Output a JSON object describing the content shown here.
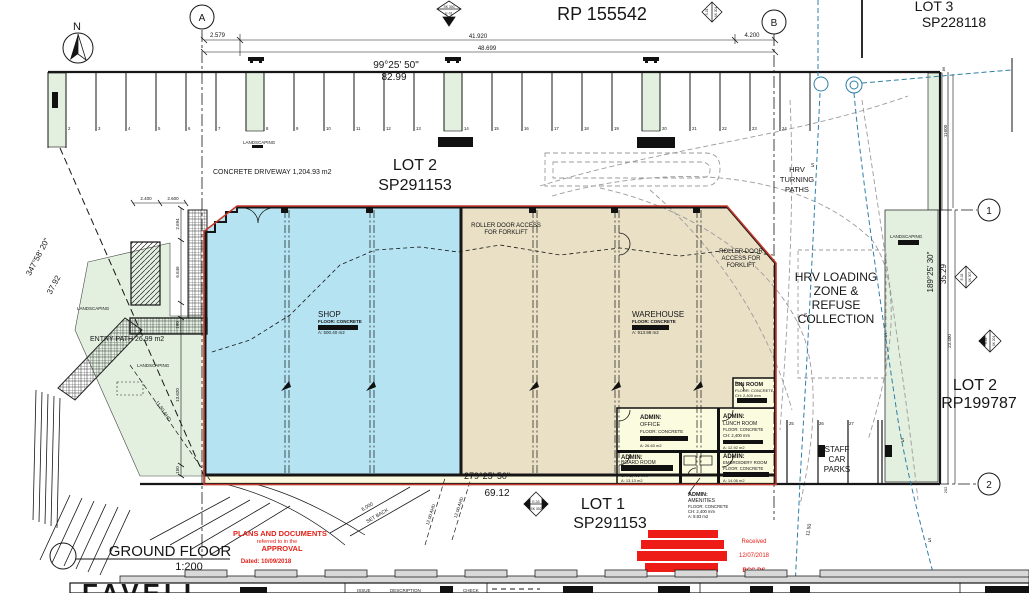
{
  "north_label": "N",
  "grid": {
    "a": "A",
    "b": "B",
    "r1": "1",
    "r2": "2"
  },
  "lots": {
    "rp_top": "RP 155542",
    "lot3_1": "LOT 3",
    "lot3_2": "SP228118",
    "lot2_1": "LOT 2",
    "lot2_2": "SP291153",
    "lot2r_1": "LOT 2",
    "lot2r_2": "RP199787",
    "lot1_1": "LOT 1",
    "lot1_2": "SP291153"
  },
  "dimensions": {
    "d1": "2.579",
    "d2": "41.920",
    "d3": "4.200",
    "d4": "48.699",
    "top_bearing": "99°25' 50\"",
    "top_dist": "82.99",
    "bottom_bearing": "279°25' 50\"",
    "bottom_dist": "69.12",
    "left_bearing": "347°58' 20\"",
    "left_dist": "37.92",
    "right_bearing": "189°25' 30\"",
    "right_dist": "35.29",
    "h1": "2.400",
    "h2": "2.600",
    "v1": "2.694",
    "v2": "6.646",
    "v3": "190",
    "v4": "13.620",
    "v5": "150",
    "r1": "11600",
    "r2": "86",
    "r3": "23.400",
    "r4": "202",
    "setback1": "6.000",
    "setback2": "SET BACK",
    "contour_left": "11.50 AHD",
    "contour_right": "11.50",
    "contour_a": "12.00 AHD",
    "contour_b": "12.00 AHD"
  },
  "site_labels": {
    "driveway": "CONCRETE DRIVEWAY 1,204.93 m2",
    "entry": "ENTRY PATH 26.99 m2",
    "landscaping": "LANDSCAPING",
    "hrv1": "HRV",
    "hrv2": "TURNING",
    "hrv3": "PATHS",
    "load1": "HRV LOADING",
    "load2": "ZONE &",
    "load3": "REFUSE",
    "load4": "COLLECTION",
    "staff1": "STAFF",
    "staff2": "CAR",
    "staff3": "PARKS",
    "roller_a1": "ROLLER DOOR ACCESS",
    "roller_a2": "FOR FORKLIFT",
    "roller_b1": "ROLLER DOOR",
    "roller_b2": "ACCESS FOR",
    "roller_b3": "FORKLIFT",
    "s": "S"
  },
  "rooms": {
    "shop_name": "SHOP",
    "shop_floor": "FLOOR: CONCRETE",
    "shop_area": "A: 500.40 m2",
    "wh_name": "WAREHOUSE",
    "wh_floor": "FLOOR: CONCRETE",
    "wh_area": "A: 913.98 m2",
    "bin_name": "BIN ROOM",
    "bin_floor": "FLOOR: CONCRETE",
    "bin_ch": "CH: 2,400 mm",
    "office_t": "ADMIN:",
    "office_n": "OFFICE",
    "office_floor": "FLOOR: CONCRETE",
    "office_area": "A: 26.63 m2",
    "lunch_t": "ADMIN:",
    "lunch_n": "LUNCH ROOM",
    "lunch_floor": "FLOOR: CONCRETE",
    "lunch_ch": "CH: 2,400 mm",
    "lunch_area": "A: 12.92 m2",
    "board_t": "ADMIN:",
    "board_n": "BOARD ROOM",
    "board_ch": "CH: 2,400 mm",
    "board_area": "A: 13.13 m2",
    "emb_t": "ADMIN:",
    "emb_n": "EMBROIDERY ROOM",
    "emb_floor": "FLOOR: CONCRETE",
    "emb_area": "A: 14.06 m2",
    "amen_t": "ADMIN:",
    "amen_n": "AMENITIES",
    "amen_floor": "FLOOR: CONCRETE",
    "amen_ch": "CH: 2,400 mm",
    "amen_area": "A: 8.83 m2"
  },
  "stalls": [
    "2",
    "3",
    "4",
    "5",
    "6",
    "7",
    "8",
    "9",
    "10",
    "11",
    "12",
    "13",
    "14",
    "15",
    "16",
    "17",
    "18",
    "19",
    "20",
    "21",
    "22",
    "23",
    "24"
  ],
  "staff_stalls": [
    "25",
    "26",
    "27"
  ],
  "markers": {
    "m1a": "SK 300",
    "m1b": "E-01",
    "m2a": "S-01",
    "m2b": "SK 201",
    "m3a": "E-02",
    "m3b": "SK 307",
    "m4a": "S-02",
    "m4b": "SK 201",
    "m5a": "E-03",
    "m5b": "SK 302"
  },
  "drawing": {
    "title": "GROUND FLOOR",
    "scale": "1:200"
  },
  "stamp": {
    "line1": "PLANS AND DOCUMENTS",
    "line2": "referred to in the",
    "line3": "APPROVAL",
    "line4": "Dated: 10/09/2018",
    "received": "Received",
    "rec_date": "12/07/2018",
    "rec_org": "BCC DS"
  },
  "titleblock": {
    "firm": "FAVELL",
    "issue": "ISSUE",
    "description": "DESCRIPTION",
    "check": "CHECK"
  },
  "colors": {
    "shop_fill": "#b5e3f2",
    "warehouse_fill": "#e9e0c6",
    "landscape_fill": "#e3f0e0",
    "room_fill": "#fbfbe0",
    "outline_red": "#c3392b",
    "stamp_red": "#ee1c16",
    "utility_blue": "#2e7fa6",
    "path_gray": "#9b9b9b"
  }
}
